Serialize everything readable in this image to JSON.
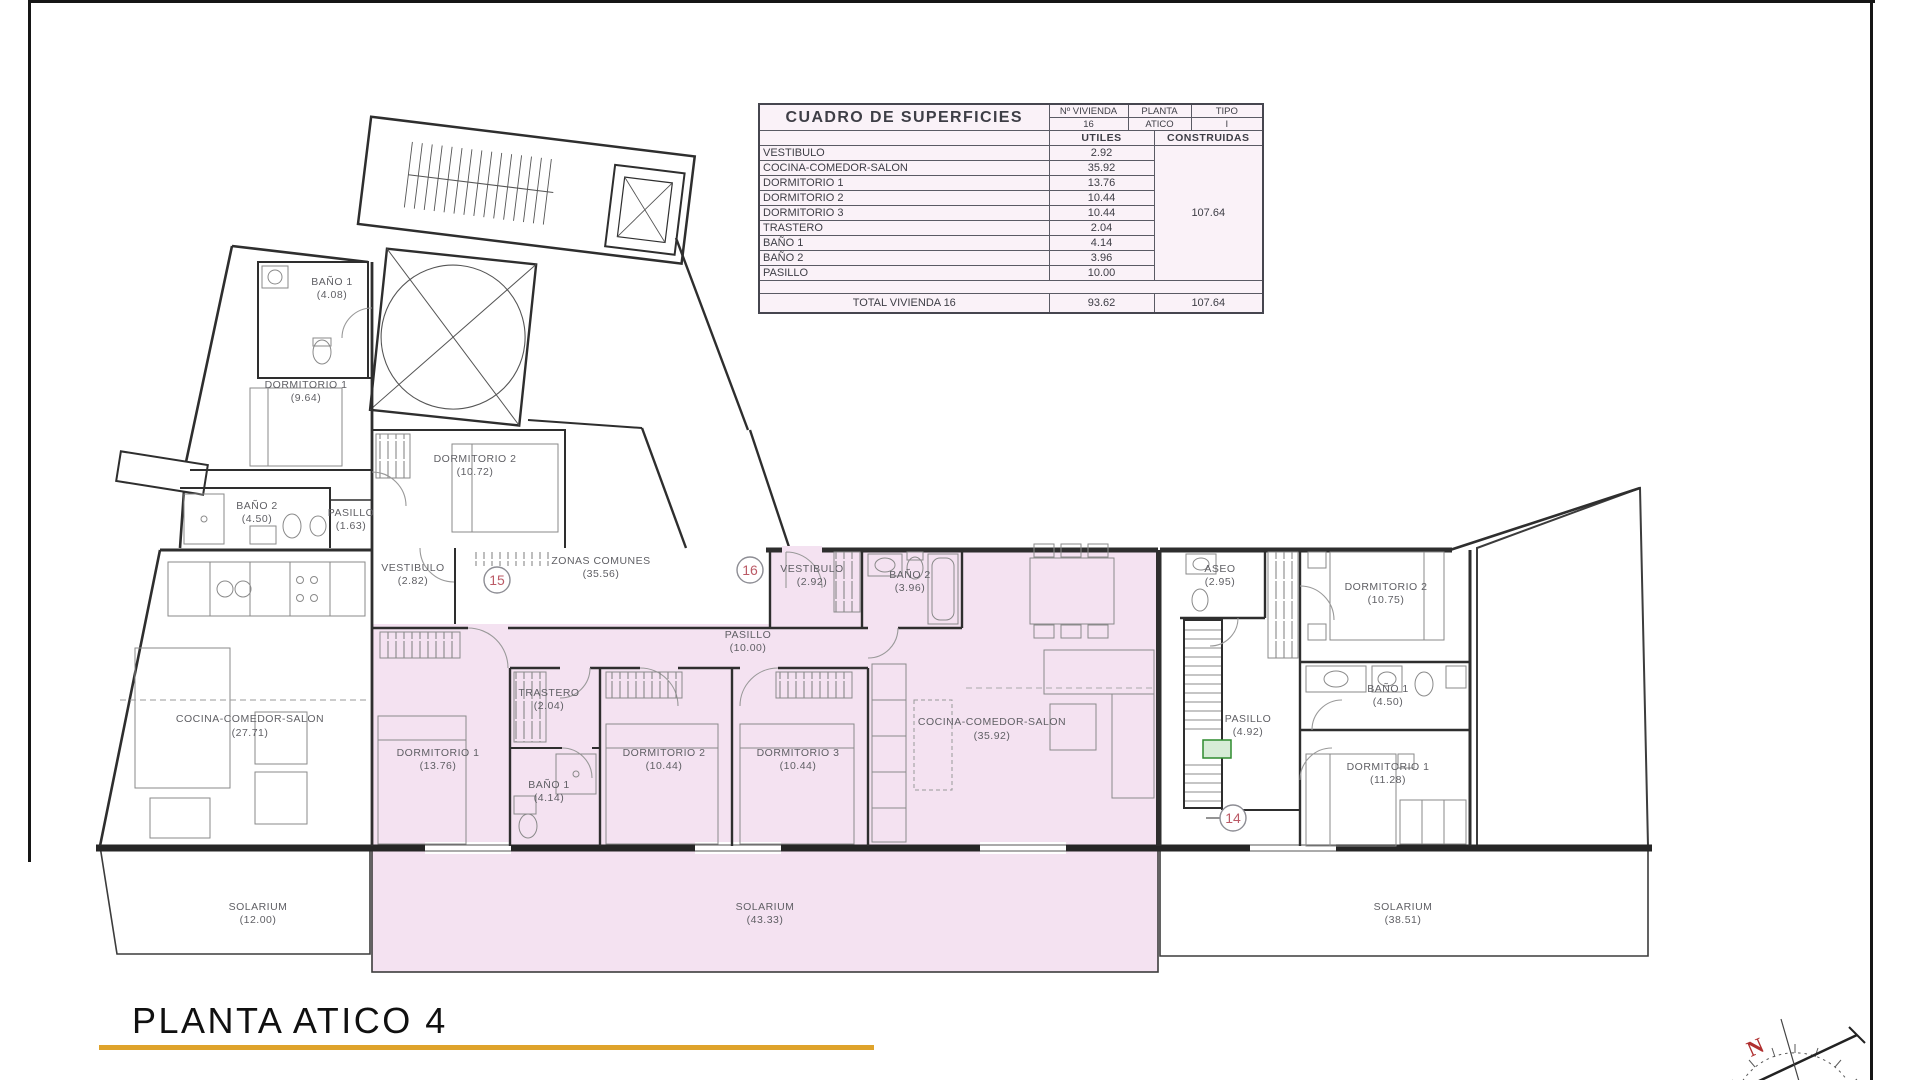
{
  "page": {
    "title": "PLANTA ATICO 4"
  },
  "colors": {
    "accent_gold": "#DFA32B",
    "unit_highlight": "#F4E2F1",
    "table_bg": "#FAF2F8",
    "badge": "#BB5A66"
  },
  "surface_table": {
    "title": "CUADRO DE SUPERFICIES",
    "col_headers": {
      "vivienda": "Nº VIVIENDA",
      "planta": "PLANTA",
      "tipo": "TIPO"
    },
    "unit": {
      "vivienda": "16",
      "planta": "ATICO",
      "tipo": "I"
    },
    "area_headers": {
      "utiles": "UTILES",
      "construidas": "CONSTRUIDAS"
    },
    "rows": [
      {
        "name": "VESTIBULO",
        "utiles": "2.92"
      },
      {
        "name": "COCINA-COMEDOR-SALON",
        "utiles": "35.92"
      },
      {
        "name": "DORMITORIO 1",
        "utiles": "13.76"
      },
      {
        "name": "DORMITORIO 2",
        "utiles": "10.44"
      },
      {
        "name": "DORMITORIO 3",
        "utiles": "10.44"
      },
      {
        "name": "TRASTERO",
        "utiles": "2.04"
      },
      {
        "name": "BAÑO 1",
        "utiles": "4.14"
      },
      {
        "name": "BAÑO 2",
        "utiles": "3.96"
      },
      {
        "name": "PASILLO",
        "utiles": "10.00"
      }
    ],
    "construidas_total": "107.64",
    "total_row": {
      "label": "TOTAL VIVIENDA 16",
      "utiles": "93.62",
      "construidas": "107.64"
    }
  },
  "plan": {
    "badges": [
      {
        "number": "15"
      },
      {
        "number": "16"
      },
      {
        "number": "14"
      }
    ],
    "labels": [
      {
        "name": "BAÑO 1",
        "area": "(4.08)"
      },
      {
        "name": "DORMITORIO 1",
        "area": "(9.64)"
      },
      {
        "name": "DORMITORIO 2",
        "area": "(10.72)"
      },
      {
        "name": "BAÑO 2",
        "area": "(4.50)"
      },
      {
        "name": "PASILLO",
        "area": "(1.63)"
      },
      {
        "name": "VESTIBULO",
        "area": "(2.82)"
      },
      {
        "name": "ZONAS COMUNES",
        "area": "(35.56)"
      },
      {
        "name": "VESTIBULO",
        "area": "(2.92)"
      },
      {
        "name": "BAÑO 2",
        "area": "(3.96)"
      },
      {
        "name": "ASEO",
        "area": "(2.95)"
      },
      {
        "name": "DORMITORIO 2",
        "area": "(10.75)"
      },
      {
        "name": "PASILLO",
        "area": "(10.00)"
      },
      {
        "name": "TRASTERO",
        "area": "(2.04)"
      },
      {
        "name": "COCINA-COMEDOR-SALON",
        "area": "(27.71)"
      },
      {
        "name": "COCINA-COMEDOR-SALON",
        "area": "(35.92)"
      },
      {
        "name": "DORMITORIO 1",
        "area": "(13.76)"
      },
      {
        "name": "BAÑO 1",
        "area": "(4.14)"
      },
      {
        "name": "DORMITORIO 2",
        "area": "(10.44)"
      },
      {
        "name": "DORMITORIO 3",
        "area": "(10.44)"
      },
      {
        "name": "PASILLO",
        "area": "(4.92)"
      },
      {
        "name": "BAÑO 1",
        "area": "(4.50)"
      },
      {
        "name": "DORMITORIO 1",
        "area": "(11.28)"
      },
      {
        "name": "SOLARIUM",
        "area": "(12.00)"
      },
      {
        "name": "SOLARIUM",
        "area": "(43.33)"
      },
      {
        "name": "SOLARIUM",
        "area": "(38.51)"
      }
    ],
    "compass": {
      "north": "N"
    }
  }
}
